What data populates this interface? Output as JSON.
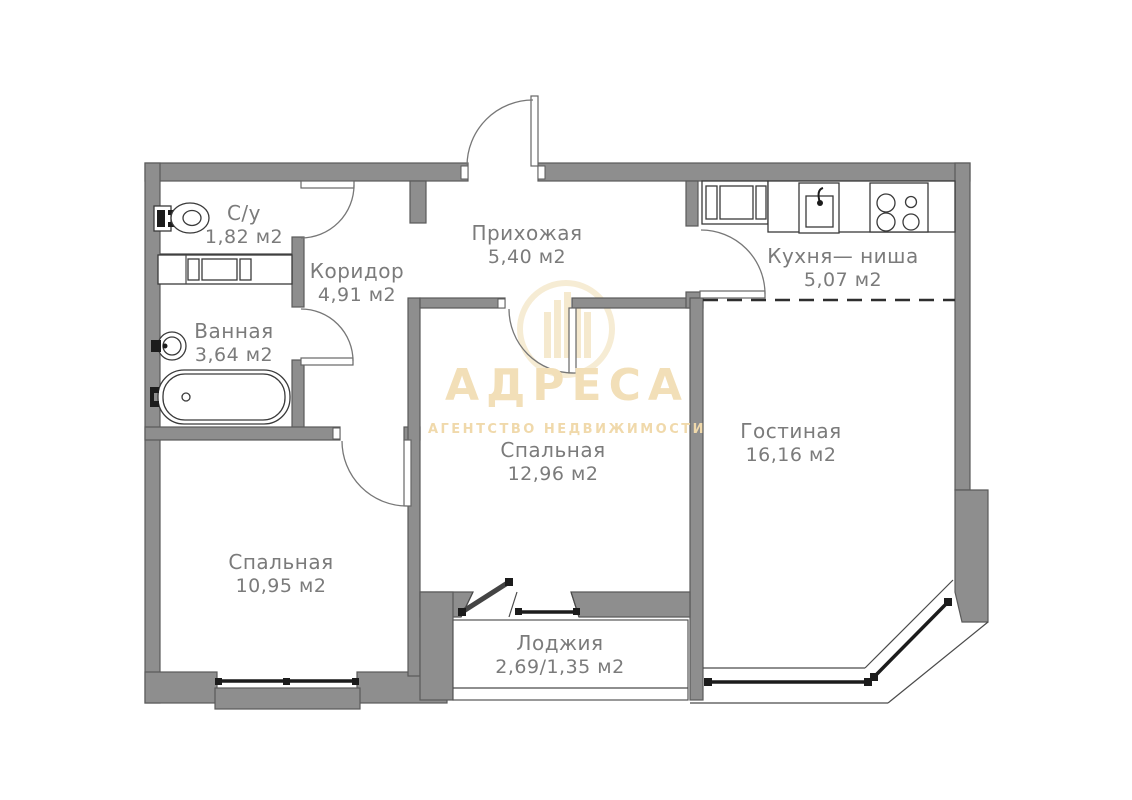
{
  "plan": {
    "background": "#ffffff",
    "wall_color": "#8e8e8e",
    "wall_outline_color": "#5a5a5a",
    "label_color": "#7b7b7b",
    "rooms": [
      {
        "name": "С/у",
        "area": "1,82 м2"
      },
      {
        "name": "Ванная",
        "area": "3,64 м2"
      },
      {
        "name": "Коридор",
        "area": "4,91 м2"
      },
      {
        "name": "Прихожая",
        "area": "5,40 м2"
      },
      {
        "name": "Кухня— ниша",
        "area": "5,07 м2"
      },
      {
        "name": "Гостиная",
        "area": "16,16 м2"
      },
      {
        "name": "Спальная",
        "area": "12,96 м2"
      },
      {
        "name": "Спальная",
        "area": "10,95 м2"
      },
      {
        "name": "Лоджия",
        "area": "2,69/1,35 м2"
      }
    ],
    "fixtures": [
      "toilet",
      "washing-machine",
      "bath-sink",
      "bathtub",
      "wardrobe",
      "kitchen-sink",
      "stove"
    ]
  },
  "watermark": {
    "brand": "АДРЕСА",
    "tagline": "АГЕНТСТВО НЕДВИЖИМОСТИ",
    "color": "#f2dfb8"
  }
}
